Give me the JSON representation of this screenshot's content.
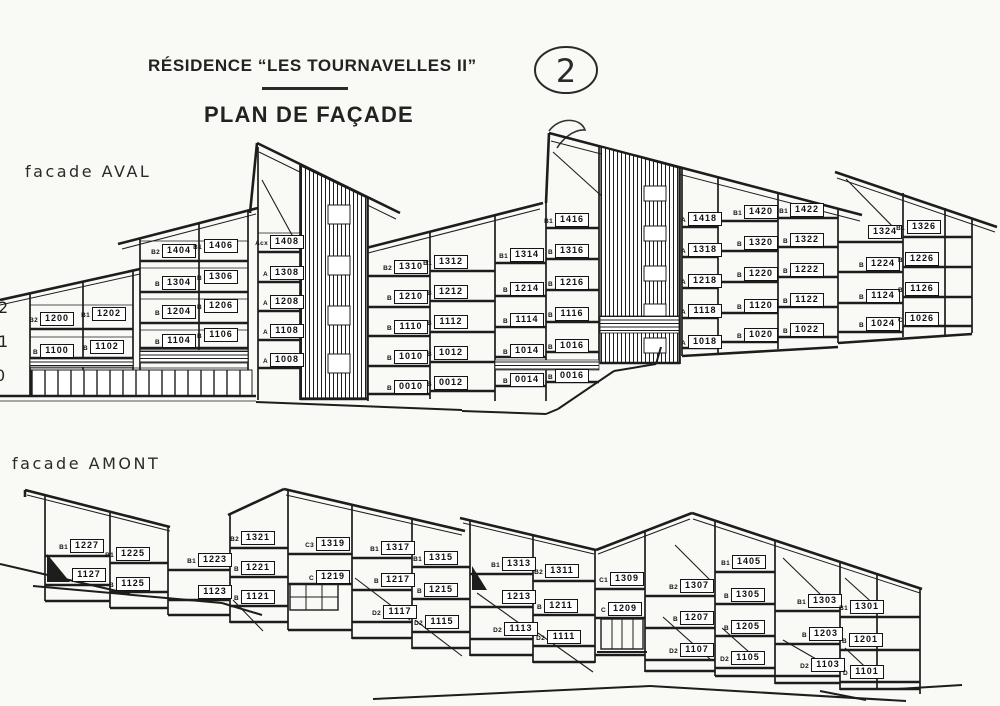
{
  "header": {
    "title": "RÉSIDENCE “LES TOURNAVELLES II”",
    "subtitle": "PLAN DE FAÇADE",
    "sheet_number": "2"
  },
  "aval": {
    "label": "facade AVAL",
    "floor_markers": [
      {
        "t": "2",
        "x": -2,
        "y": 298
      },
      {
        "t": "1",
        "x": -2,
        "y": 332
      },
      {
        "t": "0",
        "x": -5,
        "y": 366
      }
    ],
    "units": [
      {
        "p": "B2",
        "n": "1200",
        "x": 40,
        "y": 312
      },
      {
        "p": "B1",
        "n": "1202",
        "x": 92,
        "y": 307
      },
      {
        "p": "B",
        "n": "1100",
        "x": 40,
        "y": 344
      },
      {
        "p": "B",
        "n": "1102",
        "x": 90,
        "y": 340
      },
      {
        "p": "B2",
        "n": "1404",
        "x": 162,
        "y": 244
      },
      {
        "p": "B1",
        "n": "1406",
        "x": 204,
        "y": 239
      },
      {
        "p": "B",
        "n": "1304",
        "x": 162,
        "y": 276
      },
      {
        "p": "B",
        "n": "1306",
        "x": 204,
        "y": 270
      },
      {
        "p": "B",
        "n": "1204",
        "x": 162,
        "y": 305
      },
      {
        "p": "B",
        "n": "1206",
        "x": 204,
        "y": 299
      },
      {
        "p": "B",
        "n": "1104",
        "x": 162,
        "y": 334
      },
      {
        "p": "B",
        "n": "1106",
        "x": 204,
        "y": 328
      },
      {
        "p": "Acx",
        "n": "1408",
        "x": 270,
        "y": 235
      },
      {
        "p": "A",
        "n": "1308",
        "x": 270,
        "y": 266
      },
      {
        "p": "A",
        "n": "1208",
        "x": 270,
        "y": 295
      },
      {
        "p": "A",
        "n": "1108",
        "x": 270,
        "y": 324
      },
      {
        "p": "A",
        "n": "1008",
        "x": 270,
        "y": 353
      },
      {
        "p": "B2",
        "n": "1310",
        "x": 394,
        "y": 260
      },
      {
        "p": "B1",
        "n": "1312",
        "x": 434,
        "y": 255
      },
      {
        "p": "B",
        "n": "1210",
        "x": 394,
        "y": 290
      },
      {
        "p": "B",
        "n": "1212",
        "x": 434,
        "y": 285
      },
      {
        "p": "B",
        "n": "1110",
        "x": 394,
        "y": 320
      },
      {
        "p": "B",
        "n": "1112",
        "x": 434,
        "y": 315
      },
      {
        "p": "B",
        "n": "1010",
        "x": 394,
        "y": 350
      },
      {
        "p": "B",
        "n": "1012",
        "x": 434,
        "y": 346
      },
      {
        "p": "B",
        "n": "0010",
        "x": 394,
        "y": 380
      },
      {
        "p": "B",
        "n": "0012",
        "x": 434,
        "y": 376
      },
      {
        "p": "B1",
        "n": "1314",
        "x": 510,
        "y": 248
      },
      {
        "p": "B",
        "n": "1214",
        "x": 510,
        "y": 282
      },
      {
        "p": "B",
        "n": "1114",
        "x": 510,
        "y": 313
      },
      {
        "p": "B",
        "n": "1014",
        "x": 510,
        "y": 344
      },
      {
        "p": "B",
        "n": "0014",
        "x": 510,
        "y": 373
      },
      {
        "p": "B1",
        "n": "1416",
        "x": 555,
        "y": 213
      },
      {
        "p": "B",
        "n": "1316",
        "x": 555,
        "y": 244
      },
      {
        "p": "B",
        "n": "1216",
        "x": 555,
        "y": 276
      },
      {
        "p": "B",
        "n": "1116",
        "x": 555,
        "y": 307
      },
      {
        "p": "B",
        "n": "1016",
        "x": 555,
        "y": 339
      },
      {
        "p": "B",
        "n": "0016",
        "x": 555,
        "y": 369
      },
      {
        "p": "A",
        "n": "1418",
        "x": 688,
        "y": 212
      },
      {
        "p": "A",
        "n": "1318",
        "x": 688,
        "y": 243
      },
      {
        "p": "A",
        "n": "1218",
        "x": 688,
        "y": 274
      },
      {
        "p": "A",
        "n": "1118",
        "x": 688,
        "y": 304
      },
      {
        "p": "A",
        "n": "1018",
        "x": 688,
        "y": 335
      },
      {
        "p": "B1",
        "n": "1420",
        "x": 744,
        "y": 205
      },
      {
        "p": "B",
        "n": "1320",
        "x": 744,
        "y": 236
      },
      {
        "p": "B",
        "n": "1220",
        "x": 744,
        "y": 267
      },
      {
        "p": "B",
        "n": "1120",
        "x": 744,
        "y": 299
      },
      {
        "p": "B",
        "n": "1020",
        "x": 744,
        "y": 328
      },
      {
        "p": "B1",
        "n": "1422",
        "x": 790,
        "y": 203
      },
      {
        "p": "B",
        "n": "1322",
        "x": 790,
        "y": 233
      },
      {
        "p": "B",
        "n": "1222",
        "x": 790,
        "y": 263
      },
      {
        "p": "B",
        "n": "1122",
        "x": 790,
        "y": 293
      },
      {
        "p": "B",
        "n": "1022",
        "x": 790,
        "y": 323
      },
      {
        "p": "",
        "n": "1324",
        "x": 868,
        "y": 225
      },
      {
        "p": "B",
        "n": "1224",
        "x": 866,
        "y": 257
      },
      {
        "p": "B",
        "n": "1124",
        "x": 866,
        "y": 289
      },
      {
        "p": "B",
        "n": "1024",
        "x": 866,
        "y": 317
      },
      {
        "p": "B1",
        "n": "1326",
        "x": 907,
        "y": 220
      },
      {
        "p": "B",
        "n": "1226",
        "x": 905,
        "y": 252
      },
      {
        "p": "B",
        "n": "1126",
        "x": 905,
        "y": 282
      },
      {
        "p": "C",
        "n": "1026",
        "x": 905,
        "y": 312
      }
    ]
  },
  "amont": {
    "label": "facade AMONT",
    "units": [
      {
        "p": "B1",
        "n": "1227",
        "x": 70,
        "y": 539
      },
      {
        "p": "",
        "n": "1127",
        "x": 72,
        "y": 568
      },
      {
        "p": "B1",
        "n": "1225",
        "x": 116,
        "y": 547
      },
      {
        "p": "B",
        "n": "1125",
        "x": 116,
        "y": 577
      },
      {
        "p": "B1",
        "n": "1223",
        "x": 198,
        "y": 553
      },
      {
        "p": "",
        "n": "1123",
        "x": 198,
        "y": 585
      },
      {
        "p": "B2",
        "n": "1321",
        "x": 241,
        "y": 531
      },
      {
        "p": "B",
        "n": "1221",
        "x": 241,
        "y": 561
      },
      {
        "p": "B",
        "n": "1121",
        "x": 241,
        "y": 590
      },
      {
        "p": "C3",
        "n": "1319",
        "x": 316,
        "y": 537
      },
      {
        "p": "C",
        "n": "1219",
        "x": 316,
        "y": 570
      },
      {
        "p": "B1",
        "n": "1317",
        "x": 381,
        "y": 541
      },
      {
        "p": "B",
        "n": "1217",
        "x": 381,
        "y": 573
      },
      {
        "p": "D2",
        "n": "1117",
        "x": 383,
        "y": 605
      },
      {
        "p": "B1",
        "n": "1315",
        "x": 424,
        "y": 551
      },
      {
        "p": "B",
        "n": "1215",
        "x": 424,
        "y": 583
      },
      {
        "p": "D2",
        "n": "1115",
        "x": 425,
        "y": 615
      },
      {
        "p": "B1",
        "n": "1313",
        "x": 502,
        "y": 557
      },
      {
        "p": "",
        "n": "1213",
        "x": 502,
        "y": 590
      },
      {
        "p": "D2",
        "n": "1113",
        "x": 504,
        "y": 622
      },
      {
        "p": "B2",
        "n": "1311",
        "x": 545,
        "y": 564
      },
      {
        "p": "B",
        "n": "1211",
        "x": 544,
        "y": 599
      },
      {
        "p": "D2",
        "n": "1111",
        "x": 547,
        "y": 630
      },
      {
        "p": "C1",
        "n": "1309",
        "x": 610,
        "y": 572
      },
      {
        "p": "C",
        "n": "1209",
        "x": 608,
        "y": 602
      },
      {
        "p": "B2",
        "n": "1307",
        "x": 680,
        "y": 579
      },
      {
        "p": "B",
        "n": "1207",
        "x": 680,
        "y": 611
      },
      {
        "p": "D2",
        "n": "1107",
        "x": 680,
        "y": 643
      },
      {
        "p": "B1",
        "n": "1405",
        "x": 732,
        "y": 555
      },
      {
        "p": "B",
        "n": "1305",
        "x": 731,
        "y": 588
      },
      {
        "p": "B",
        "n": "1205",
        "x": 731,
        "y": 620
      },
      {
        "p": "D2",
        "n": "1105",
        "x": 731,
        "y": 651
      },
      {
        "p": "B1",
        "n": "1303",
        "x": 808,
        "y": 594
      },
      {
        "p": "B",
        "n": "1203",
        "x": 809,
        "y": 627
      },
      {
        "p": "D2",
        "n": "1103",
        "x": 811,
        "y": 658
      },
      {
        "p": "B1",
        "n": "1301",
        "x": 850,
        "y": 600
      },
      {
        "p": "B",
        "n": "1201",
        "x": 849,
        "y": 633
      },
      {
        "p": "D",
        "n": "1101",
        "x": 850,
        "y": 665
      }
    ]
  }
}
